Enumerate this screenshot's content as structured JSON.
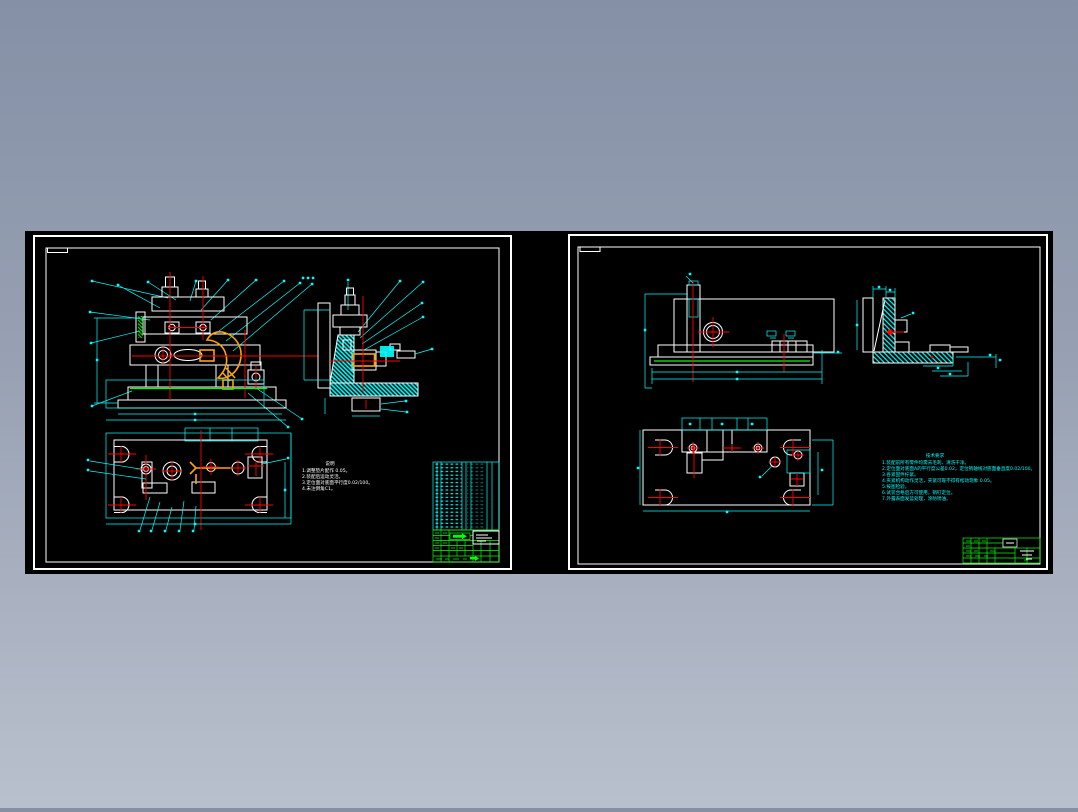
{
  "colors": {
    "background_top": "#8590a6",
    "background_bottom": "#b9c0cd",
    "paper": "#000000",
    "line_white": "#ffffff",
    "line_cyan": "#00ffff",
    "line_green": "#00ff00",
    "line_red": "#ff0000",
    "line_orange": "#ffa500",
    "title_block_green": "#00ff00"
  },
  "left_sheet": {
    "notes": {
      "title": "说明",
      "lines": [
        "1.调整垫片配作 0.05。",
        "2.装配后运动灵活。",
        "3.定位面对底面平行度0.02/100。",
        "4.未注倒角C1。"
      ]
    },
    "bom": {
      "visible_rows": 18,
      "visible_columns": 7
    }
  },
  "right_sheet": {
    "notes": {
      "title": "技术要求",
      "lines": [
        "1.装配前所有零件均需去毛刺、清洗干净。",
        "2.定位面对底面A的平行度公差0.02，定位销轴线对底面垂直度0.02/100。",
        "3.各紧固件拧紧。",
        "4.夹紧机构动作灵活，夹紧可靠不得有松动现象 0.05。",
        "5.按图检验。",
        "6.试装合格后方可使用，销钉定位。",
        "7.外露表面发蓝处理，涂防锈油。"
      ]
    }
  }
}
